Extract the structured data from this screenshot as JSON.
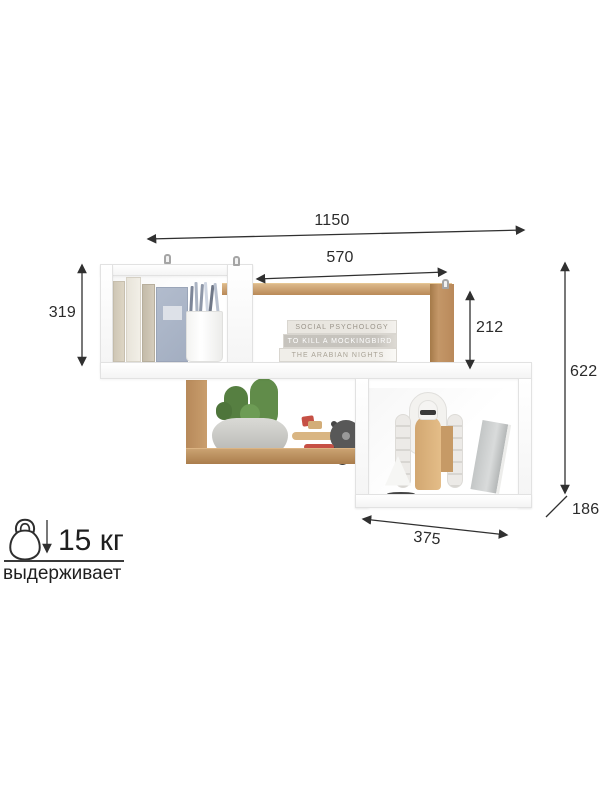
{
  "dimensions": {
    "total_width": "1150",
    "upper_shelf_width": "570",
    "left_box_height": "319",
    "right_drop_height": "212",
    "total_height": "622",
    "depth": "186",
    "right_box_width": "375"
  },
  "load": {
    "weight_label": "15 кг",
    "caption": "выдерживает"
  },
  "icons": {
    "load_icon": "kettlebell-icon",
    "load_arrow": "arrow-down-icon"
  },
  "decor": {
    "book_stack_titles": [
      "SOCIAL PSYCHOLOGY",
      "TO KILL A MOCKINGBIRD",
      "THE ARABIAN NIGHTS"
    ]
  },
  "colors": {
    "dimension_line": "#303030",
    "oak_wood": "#bb8f5f",
    "white_panel": "#fbfbfb",
    "cactus_green": "#5d8a47",
    "toy_red": "#c65045",
    "background": "#ffffff"
  }
}
